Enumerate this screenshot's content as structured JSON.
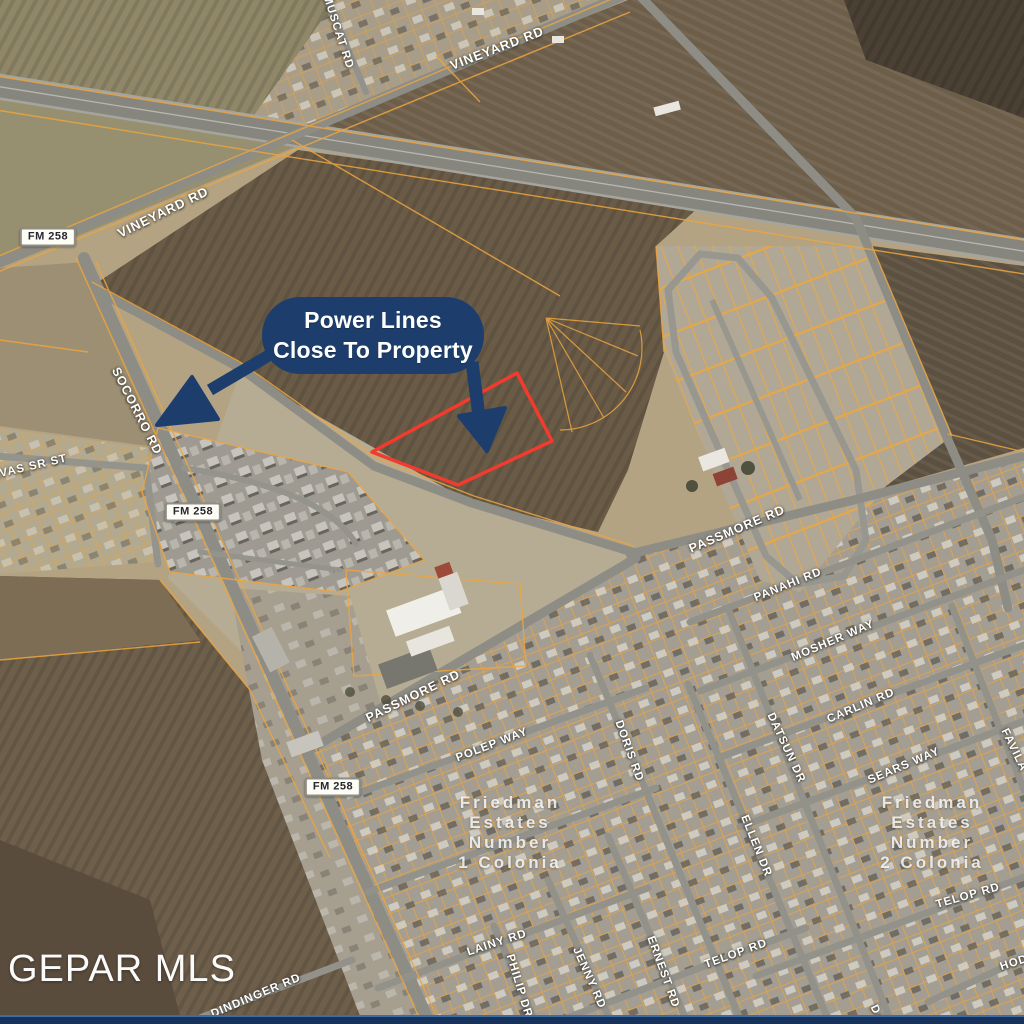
{
  "title": "Aerial parcel map with power lines callout",
  "watermark": "GEPAR MLS",
  "callout": {
    "line1": "Power Lines",
    "line2": "Close To Property"
  },
  "colors": {
    "callout_navy": "#1d3e6c",
    "property_outline_red": "#f23b2e",
    "parcel_line_orange": "#eda53f",
    "road_gray": "#8e8d85",
    "bottom_bar_blue": "#16325a"
  },
  "route_badges": [
    {
      "text": "FM 258"
    },
    {
      "text": "FM 258"
    },
    {
      "text": "FM 258"
    }
  ],
  "subdivisions": [
    {
      "lines": [
        "Friedman",
        "Estates",
        "Number",
        "1 Colonia"
      ]
    },
    {
      "lines": [
        "Friedman",
        "Estates",
        "Number",
        "2 Colonia"
      ]
    }
  ],
  "road_labels": [
    {
      "text": "MUSCAT RD"
    },
    {
      "text": "VINEYARD RD"
    },
    {
      "text": "VINEYARD RD"
    },
    {
      "text": "SOCORRO RD"
    },
    {
      "text": "LVAS SR ST"
    },
    {
      "text": "PASSMORE RD"
    },
    {
      "text": "PANAHI RD"
    },
    {
      "text": "MOSHER WAY"
    },
    {
      "text": "CARLIN RD"
    },
    {
      "text": "DATSUN DR"
    },
    {
      "text": "SEARS WAY"
    },
    {
      "text": "FAVILA"
    },
    {
      "text": "PASSMORE RD"
    },
    {
      "text": "POLEP WAY"
    },
    {
      "text": "DORIS RD"
    },
    {
      "text": "ELLEN DR"
    },
    {
      "text": "TELOP RD"
    },
    {
      "text": "TELOP RD"
    },
    {
      "text": "LAINY RD"
    },
    {
      "text": "PHILIP DR"
    },
    {
      "text": "JENNY RD"
    },
    {
      "text": "ERNEST RD"
    },
    {
      "text": "DINDINGER RD"
    },
    {
      "text": "HOD"
    },
    {
      "text": "DA"
    }
  ]
}
